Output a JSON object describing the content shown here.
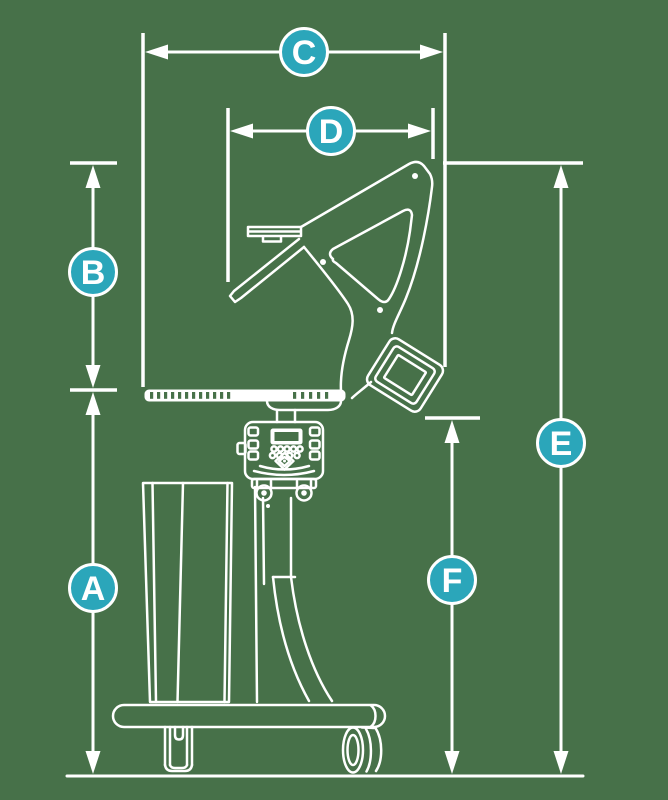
{
  "colors": {
    "background": "#477149",
    "line": "#ffffff",
    "accent": "#2BA6BA",
    "label_text": "#ffffff"
  },
  "labels": [
    {
      "letter": "C"
    },
    {
      "letter": "D"
    },
    {
      "letter": "B"
    },
    {
      "letter": "A"
    },
    {
      "letter": "E"
    },
    {
      "letter": "F"
    }
  ]
}
